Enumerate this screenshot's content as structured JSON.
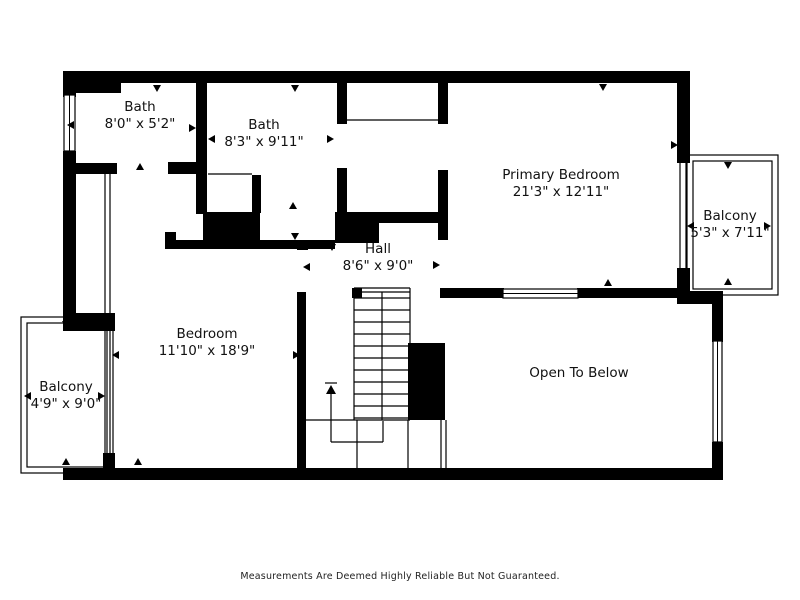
{
  "page": {
    "background": "#ffffff",
    "footer_note": "Measurements Are Deemed Highly Reliable But Not Guaranteed."
  },
  "floorplan": {
    "wall_color": "#000000",
    "line_color": "#000000",
    "text_color": "#111111",
    "rooms": [
      {
        "id": "bath-1",
        "name": "Bath",
        "dims": "8'0\" x 5'2\"",
        "x": 140,
        "y": 111
      },
      {
        "id": "bath-2",
        "name": "Bath",
        "dims": "8'3\" x 9'11\"",
        "x": 264,
        "y": 129
      },
      {
        "id": "primary-bedroom",
        "name": "Primary Bedroom",
        "dims": "21'3\" x 12'11\"",
        "x": 561,
        "y": 179
      },
      {
        "id": "balcony-right",
        "name": "Balcony",
        "dims": "5'3\" x 7'11\"",
        "x": 730,
        "y": 220
      },
      {
        "id": "hall",
        "name": "Hall",
        "dims": "8'6\" x 9'0\"",
        "x": 378,
        "y": 253
      },
      {
        "id": "bedroom",
        "name": "Bedroom",
        "dims": "11'10\" x 18'9\"",
        "x": 207,
        "y": 338
      },
      {
        "id": "balcony-left",
        "name": "Balcony",
        "dims": "4'9\" x 9'0\"",
        "x": 66,
        "y": 391
      },
      {
        "id": "open-to-below",
        "name": "Open To Below",
        "dims": "",
        "x": 579,
        "y": 377
      }
    ],
    "walls": [
      [
        63,
        71,
        627,
        12
      ],
      [
        63,
        83,
        58,
        10
      ],
      [
        63,
        83,
        13,
        14
      ],
      [
        63,
        151,
        13,
        180
      ],
      [
        63,
        163,
        54,
        11
      ],
      [
        63,
        313,
        52,
        18
      ],
      [
        103,
        453,
        12,
        17
      ],
      [
        63,
        468,
        660,
        12
      ],
      [
        196,
        83,
        11,
        131
      ],
      [
        168,
        162,
        32,
        12
      ],
      [
        203,
        212,
        57,
        31
      ],
      [
        252,
        175,
        9,
        38
      ],
      [
        337,
        83,
        10,
        41
      ],
      [
        337,
        168,
        10,
        46
      ],
      [
        335,
        212,
        44,
        31
      ],
      [
        378,
        212,
        70,
        11
      ],
      [
        438,
        83,
        10,
        41
      ],
      [
        438,
        170,
        10,
        70
      ],
      [
        165,
        232,
        11,
        17
      ],
      [
        165,
        240,
        170,
        9
      ],
      [
        297,
        243,
        11,
        7
      ],
      [
        297,
        292,
        9,
        176
      ],
      [
        352,
        288,
        10,
        10
      ],
      [
        440,
        288,
        10,
        10
      ],
      [
        448,
        288,
        56,
        10
      ],
      [
        577,
        288,
        113,
        10
      ],
      [
        408,
        343,
        37,
        77
      ],
      [
        677,
        71,
        13,
        92
      ],
      [
        677,
        268,
        13,
        27
      ],
      [
        677,
        291,
        46,
        13
      ],
      [
        712,
        302,
        11,
        40
      ],
      [
        712,
        442,
        11,
        28
      ]
    ],
    "windows": [
      {
        "x": 64,
        "y": 95,
        "w": 11,
        "h": 56,
        "orient": "v"
      },
      {
        "x": 503,
        "y": 289,
        "w": 75,
        "h": 9,
        "orient": "h"
      },
      {
        "x": 713,
        "y": 341,
        "w": 9,
        "h": 101,
        "orient": "v"
      }
    ],
    "balconies": [
      {
        "outer": [
          21,
          317,
          92,
          156
        ],
        "inner": [
          27,
          323,
          80,
          144
        ]
      },
      {
        "outer": [
          687,
          155,
          91,
          140
        ],
        "inner": [
          693,
          161,
          79,
          128
        ]
      }
    ],
    "thin_lines": [
      [
        105,
        168,
        105,
        453
      ],
      [
        110,
        168,
        110,
        453
      ],
      [
        680,
        163,
        680,
        268
      ],
      [
        686,
        163,
        686,
        268
      ],
      [
        347,
        120,
        438,
        120
      ],
      [
        208,
        174,
        252,
        174
      ],
      [
        354,
        288,
        410,
        288
      ],
      [
        354,
        292,
        410,
        292
      ],
      [
        354,
        288,
        354,
        420
      ],
      [
        410,
        288,
        410,
        343
      ],
      [
        382,
        292,
        382,
        420
      ],
      [
        305,
        420,
        410,
        420
      ],
      [
        357,
        420,
        357,
        468
      ],
      [
        408,
        420,
        408,
        468
      ],
      [
        441,
        420,
        441,
        468
      ],
      [
        446,
        420,
        446,
        468
      ],
      [
        325,
        383,
        337,
        383
      ],
      [
        331,
        394,
        331,
        442
      ],
      [
        331,
        442,
        383,
        442
      ],
      [
        383,
        421,
        383,
        442
      ]
    ],
    "stairs": {
      "x1": 354,
      "x2": 410,
      "y_start": 298,
      "step": 12,
      "count": 11
    },
    "stair_arrow": {
      "points": "331,385 326,394 336,394"
    },
    "markers": [
      {
        "x": 157,
        "y": 88,
        "dir": "down"
      },
      {
        "x": 295,
        "y": 88,
        "dir": "down"
      },
      {
        "x": 603,
        "y": 87,
        "dir": "down"
      },
      {
        "x": 295,
        "y": 236,
        "dir": "down"
      },
      {
        "x": 332,
        "y": 247,
        "dir": "down"
      },
      {
        "x": 66,
        "y": 324,
        "dir": "down"
      },
      {
        "x": 728,
        "y": 165,
        "dir": "down"
      },
      {
        "x": 140,
        "y": 167,
        "dir": "up"
      },
      {
        "x": 293,
        "y": 206,
        "dir": "up"
      },
      {
        "x": 608,
        "y": 283,
        "dir": "up"
      },
      {
        "x": 138,
        "y": 462,
        "dir": "up"
      },
      {
        "x": 66,
        "y": 462,
        "dir": "up"
      },
      {
        "x": 728,
        "y": 282,
        "dir": "up"
      },
      {
        "x": 71,
        "y": 125,
        "dir": "left"
      },
      {
        "x": 212,
        "y": 139,
        "dir": "left"
      },
      {
        "x": 307,
        "y": 267,
        "dir": "left"
      },
      {
        "x": 116,
        "y": 355,
        "dir": "left"
      },
      {
        "x": 28,
        "y": 396,
        "dir": "left"
      },
      {
        "x": 691,
        "y": 226,
        "dir": "left"
      },
      {
        "x": 192,
        "y": 128,
        "dir": "right"
      },
      {
        "x": 330,
        "y": 139,
        "dir": "right"
      },
      {
        "x": 436,
        "y": 265,
        "dir": "right"
      },
      {
        "x": 296,
        "y": 355,
        "dir": "right"
      },
      {
        "x": 101,
        "y": 396,
        "dir": "right"
      },
      {
        "x": 767,
        "y": 226,
        "dir": "right"
      },
      {
        "x": 674,
        "y": 145,
        "dir": "right"
      }
    ]
  }
}
